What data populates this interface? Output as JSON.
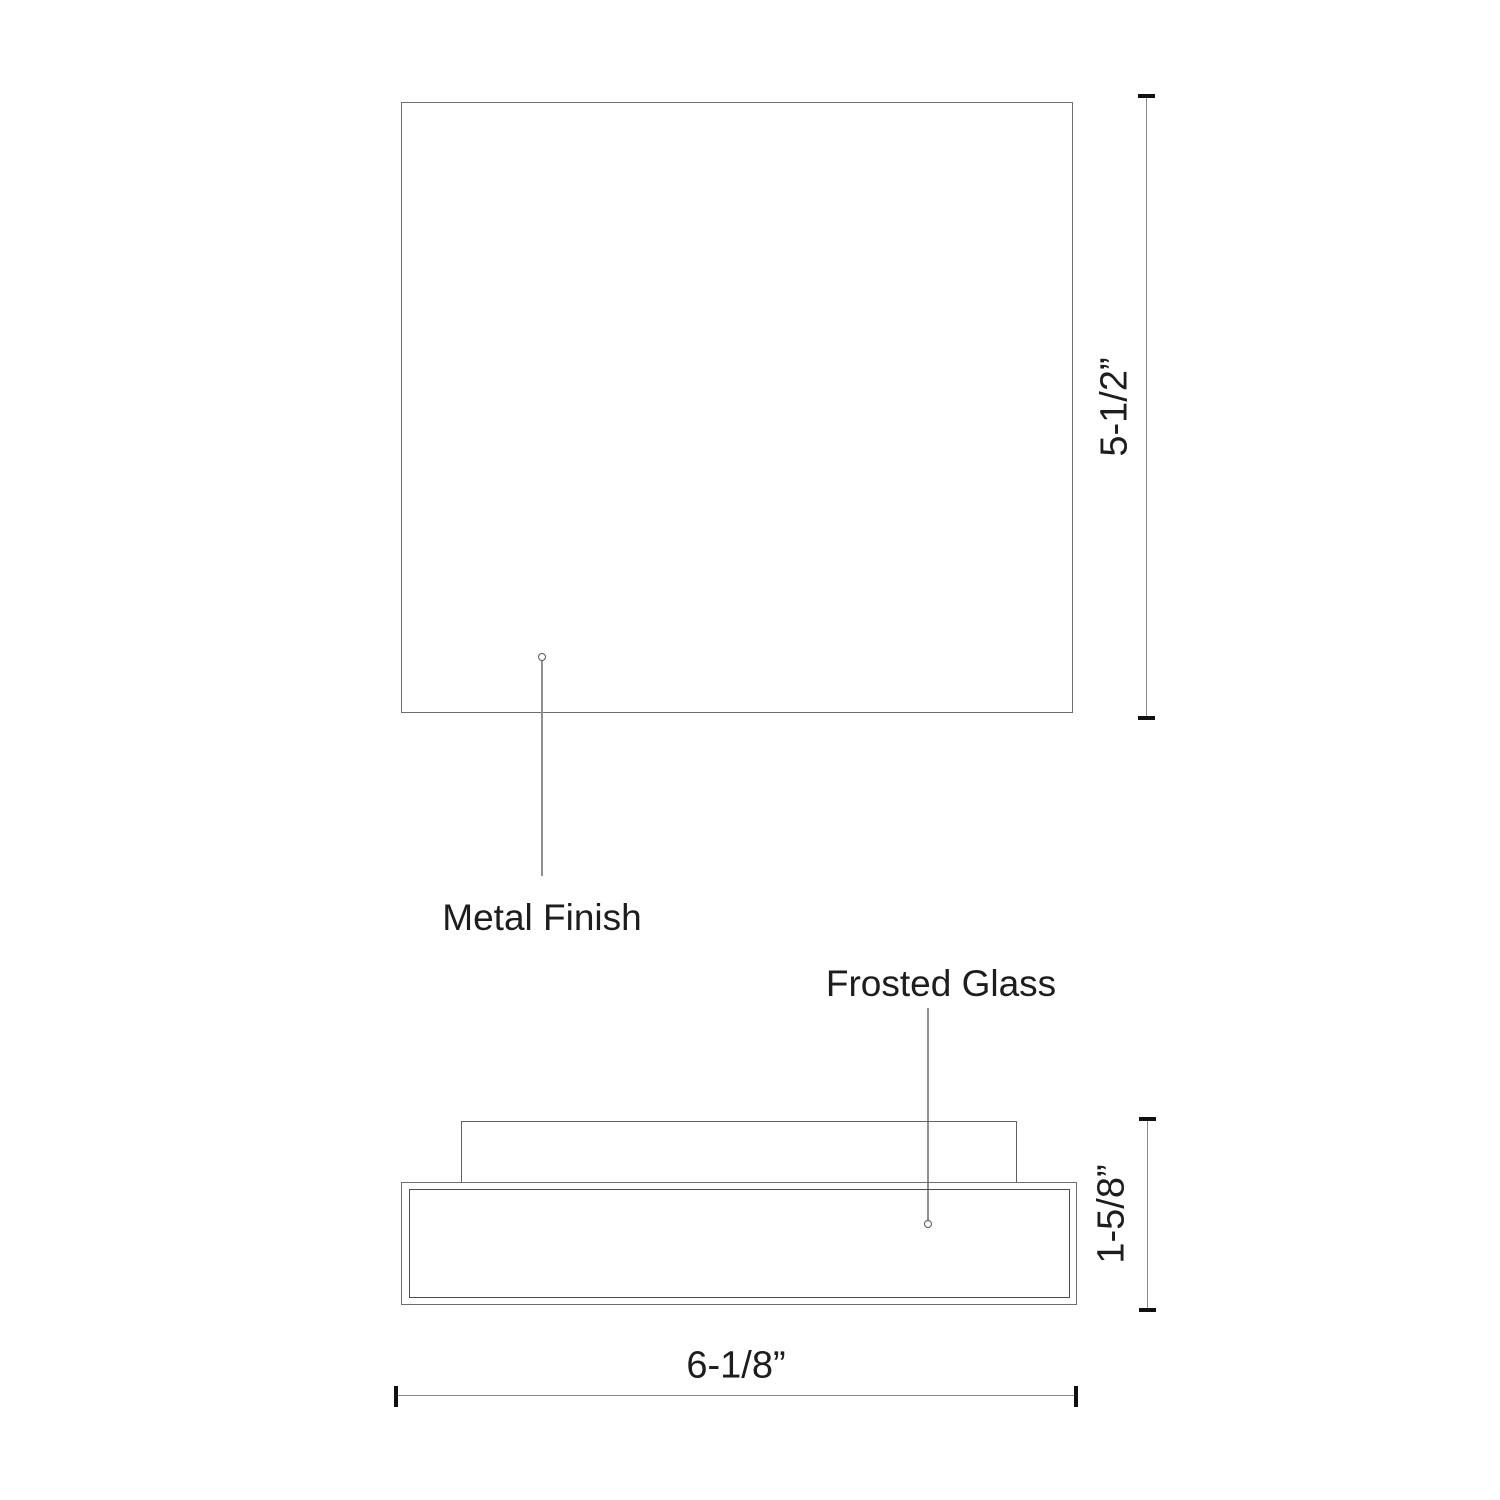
{
  "drawing": {
    "type": "product-dimension-diagram",
    "callouts": {
      "metal_finish": "Metal Finish",
      "frosted_glass": "Frosted Glass"
    },
    "dimensions": {
      "top_view_height": "5-1/2”",
      "side_view_height": "1-5/8”",
      "width": "6-1/8”"
    },
    "colors": {
      "outline": "#6e6e6e",
      "inner_outline": "#4a4a4a",
      "leader": "#8f8f8f",
      "dimension_line": "#8a8a8a",
      "tick": "#111111",
      "text": "#1d1d1d",
      "background": "#ffffff"
    }
  }
}
